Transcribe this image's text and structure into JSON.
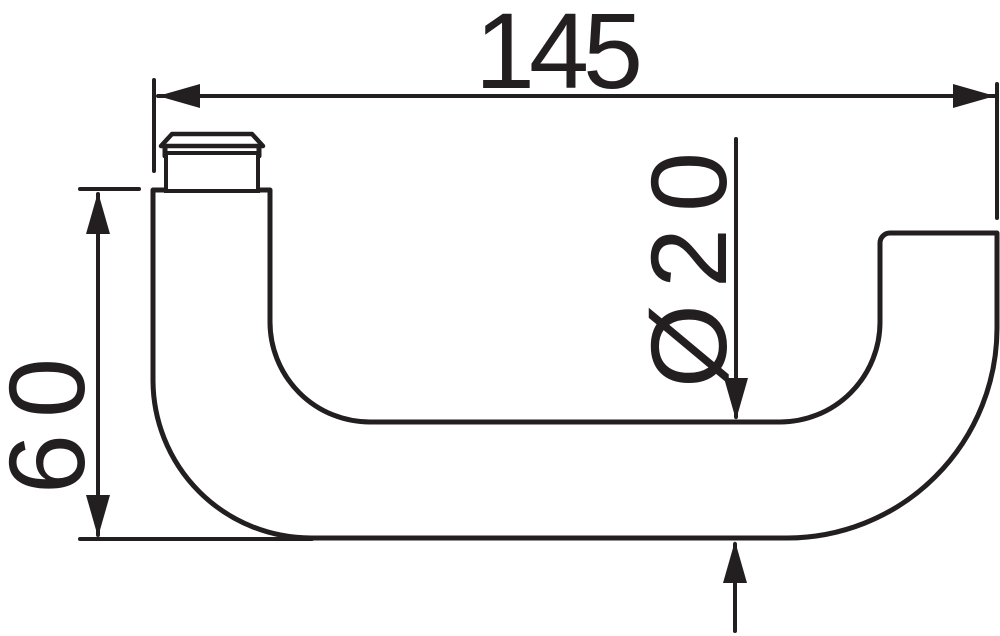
{
  "drawing": {
    "subject": "door-lever-handle-profile",
    "dimensions": {
      "width": "145",
      "height": "60",
      "diameter": "Ø20"
    },
    "colors": {
      "ink": "#231f20",
      "background": "#ffffff"
    }
  }
}
